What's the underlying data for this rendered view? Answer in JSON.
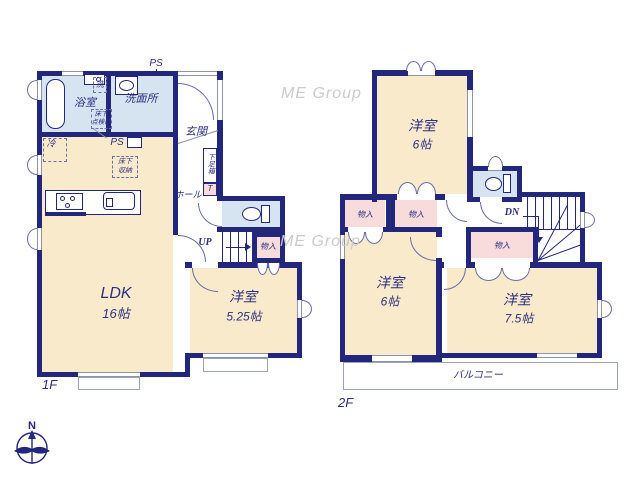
{
  "watermark": {
    "text": "ME Group"
  },
  "compass": {
    "north": "N"
  },
  "colors": {
    "wall": "#23277c",
    "room_fill": "#faeacc",
    "wet_fill": "#d6e3f1",
    "storage_fill": "#f8dbdb",
    "text": "#2b2f80",
    "watermark": "#cbcbcb"
  },
  "floor1": {
    "label": "1F",
    "ldk": {
      "name": "LDK",
      "size": "16帖"
    },
    "bedroom": {
      "name": "洋室",
      "size": "5.25帖"
    },
    "bath": {
      "name": "浴室"
    },
    "washroom": {
      "name": "洗面所"
    },
    "entrance": {
      "name": "玄関"
    },
    "hall": {
      "name": "ホール"
    },
    "shoebox": {
      "name": "下足箱",
      "t": "T"
    },
    "closet": {
      "name": "物入"
    },
    "stairs": {
      "label": "UP"
    },
    "ps_top": "PS",
    "ps_kitchen": "PS",
    "washer": "洗",
    "fridge": "冷",
    "floor_hatch": "床下\n点検口",
    "floor_storage": "床下\n収納"
  },
  "floor2": {
    "label": "2F",
    "bedroom_north": {
      "name": "洋室",
      "size": "6帖"
    },
    "bedroom_west": {
      "name": "洋室",
      "size": "6帖"
    },
    "bedroom_east": {
      "name": "洋室",
      "size": "7.5帖"
    },
    "balcony": {
      "name": "バルコニー"
    },
    "closet_a": {
      "name": "物入"
    },
    "closet_b": {
      "name": "物入"
    },
    "closet_c": {
      "name": "物入"
    },
    "stairs": {
      "label": "DN"
    }
  }
}
